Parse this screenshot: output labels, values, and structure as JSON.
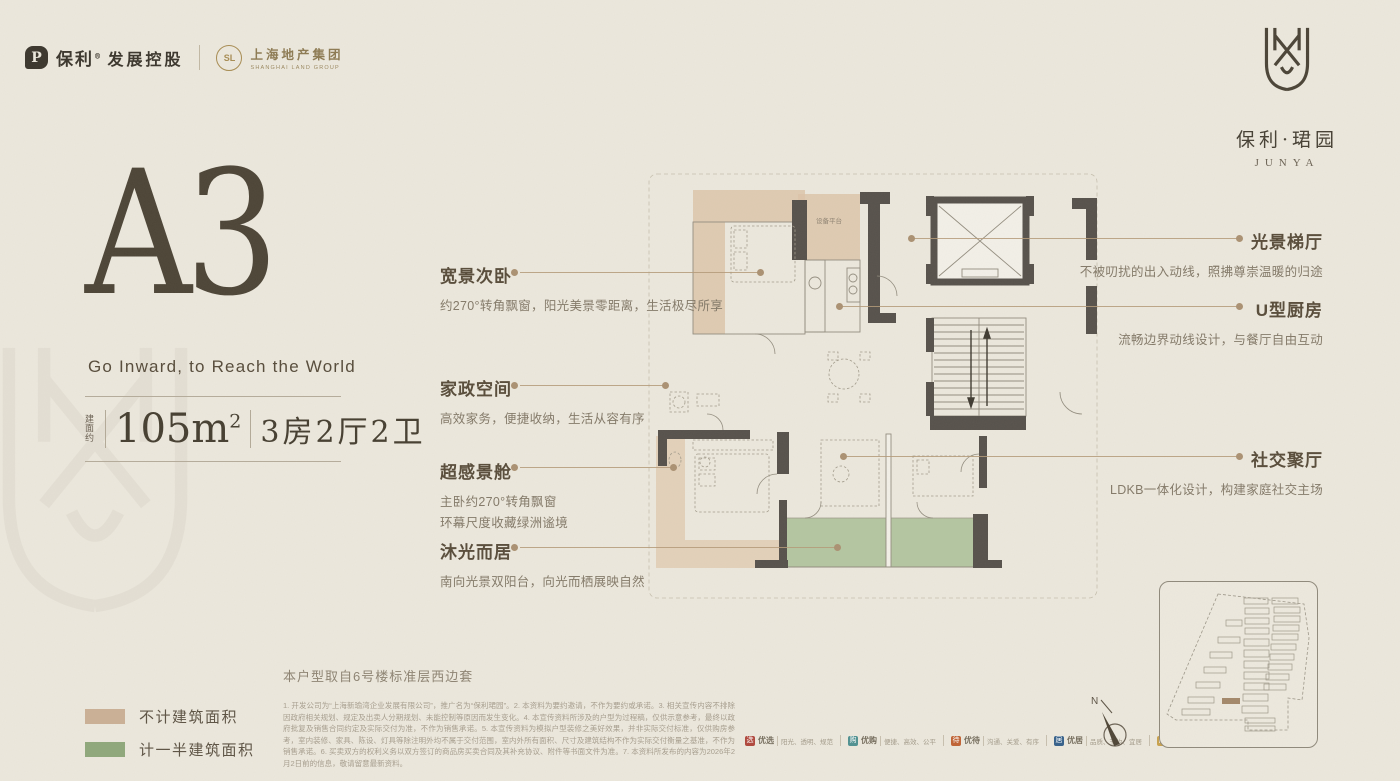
{
  "header": {
    "poly": {
      "icon_letter": "P",
      "brand": "保利",
      "reg": "®",
      "suffix": "发展控股"
    },
    "shland": {
      "initials": "SL",
      "cn": "上海地产集团",
      "en": "SHANGHAI LAND GROUP"
    },
    "project": {
      "cn": "保利·珺园",
      "en": "JUNYA"
    }
  },
  "hero": {
    "unit": "A3",
    "tagline": "Go Inward, to Reach the World",
    "area_prefix": "建面约",
    "area_num": "105m",
    "area_sup": "2",
    "layout": "3房2厅2卫"
  },
  "callouts": {
    "left": [
      {
        "title": "宽景次卧",
        "desc": "约270°转角飘窗，阳光美景零距离，生活极尽所享"
      },
      {
        "title": "家政空间",
        "desc": "高效家务，便捷收纳，生活从容有序"
      },
      {
        "title": "超感景舱",
        "desc": "主卧约270°转角飘窗",
        "desc2": "环幕尺度收藏绿洲谧境"
      },
      {
        "title": "沐光而居",
        "desc": "南向光景双阳台，向光而栖展映自然"
      }
    ],
    "right": [
      {
        "title": "光景梯厅",
        "desc": "不被叨扰的出入动线，照拂尊崇温暖的归途"
      },
      {
        "title": "U型厨房",
        "desc": "流畅边界动线设计，与餐厅自由互动"
      },
      {
        "title": "社交聚厅",
        "desc": "LDKB一体化设计，构建家庭社交主场"
      }
    ]
  },
  "plan": {
    "equipment_label": "设备平台"
  },
  "legend": {
    "items": [
      {
        "label": "不计建筑面积",
        "color": "#cbb096"
      },
      {
        "label": "计一半建筑面积",
        "color": "#8fa87b"
      }
    ]
  },
  "footnote": {
    "source": "本户型取自6号楼标准层西边套",
    "disclaimer": "1. 开发公司为“上海新瑜湾企业发展有限公司”，推广名为“保利珺园”。2. 本资料为要约邀请，不作为要约或承诺。3. 相关宣传内容不排除因政府相关规划、规定及出卖人分期规划、未能控制等原因而发生变化。4. 本宣传资料所涉及的户型为过程稿，仅供示意参考，最终以政府批复及销售合同约定及实际交付为准，不作为销售承诺。5. 本宣传资料为模拟户型装修之美好效果，并非实际交付标准，仅供购房参考，室内装修、家具、陈设、灯具等除注明外均不属于交付范围，室内外所有面积、尺寸及建筑结构不作为实际交付衡量之基准，不作为销售承诺。6. 买卖双方的权利义务以双方签订的商品房买卖合同及其补充协议、附件等书面文件为准。7. 本资料所发布的内容为2026年2月2日前的信息，敬请留意最新资料。"
  },
  "badges": [
    {
      "char": "选",
      "label": "优选",
      "desc": "阳光、透明、规范",
      "color": "#b0463b"
    },
    {
      "char": "购",
      "label": "优购",
      "desc": "便捷、高效、公平",
      "color": "#4f9191"
    },
    {
      "char": "待",
      "label": "优待",
      "desc": "沟通、关爱、有序",
      "color": "#c06233"
    },
    {
      "char": "居",
      "label": "优居",
      "desc": "品质、节约、宜居",
      "color": "#35608a"
    },
    {
      "char": "图",
      "label": "优图",
      "desc": "相邻、美好、温情",
      "color": "#c9a24e"
    }
  ],
  "compass": {
    "label": "N"
  },
  "colors": {
    "tan": "#dcc3a8",
    "green": "#afc39b",
    "wall": "#56514b",
    "leader": "#b49a78",
    "paper": "#ece8dd"
  }
}
